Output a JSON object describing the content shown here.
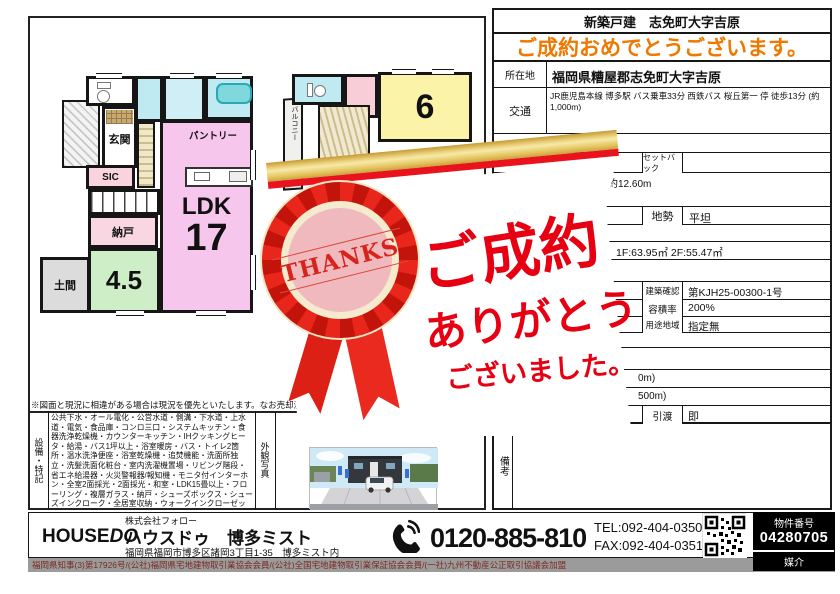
{
  "right_panel": {
    "title": "新築戸建　志免町大字吉原",
    "congrats": "ご成約おめでとうございます。",
    "rows": {
      "location_label": "所在地",
      "location_value": "福岡県糟屋郡志免町大字吉原",
      "access_label": "交通",
      "access_value": "JR鹿児島本線 博多駅 バス乗車33分 西鉄バス 桜丘第一 停 徒歩13分 (約1,000m)",
      "setback_label": "セットバック",
      "setback_value": "",
      "road_fragment": "約12.60m",
      "terrain_label": "地勢",
      "terrain_value": "平坦",
      "area_fragment": "1F:63.95㎡ 2F:55.47㎡",
      "confirmation_label": "建築確認",
      "confirmation_value": "第KJH25-00300-1号",
      "far_label": "容積率",
      "far_value": "200%",
      "zoning_label": "用途地域",
      "zoning_value": "指定無",
      "distance_fragment1": "0m)",
      "distance_fragment2": "500m)",
      "handover_label": "引渡",
      "handover_value": "即",
      "remarks_label": "備考"
    }
  },
  "floorplan": {
    "f1": {
      "genkan": "玄関",
      "sic": "SIC",
      "nando": "納戸",
      "washitsu_size": "4.5",
      "doma": "土間",
      "pantry": "パントリー",
      "ldk": "LDK",
      "ldk_size": "17"
    },
    "f2": {
      "room_size": "6",
      "balcony": "バルコニー"
    }
  },
  "ribbon": {
    "thanks": "THANKS"
  },
  "message": {
    "line1": "ご成約",
    "line2": "ありがとう",
    "line3": "ございました。"
  },
  "notes": {
    "disclaimer": "※図面と現況に相違がある場合は現況を優先といたします。なお売却済の場合",
    "equipment_label": "設備・特記",
    "equipment": "公共下水・オール電化・公営水道・側溝・下水道・上水道・電気・食品庫・コンロ三口・システムキッチン・食器洗浄乾燥機・カウンターキッチン・IHクッキングヒータ・給湯・バス1坪以上・浴室暖房・バス・トイレ2箇所・温水洗浄便座・浴室乾燥機・追焚機能・洗面所独立・洗髪洗面化粧台・室内洗濯機置場・リビング階段・省エネ給湯器・火災警報器/報知機・モニタ付インターホン・全室2面採光・2面採光・和室・LDK15畳以上・フローリング・複層ガラス・納戸・シューズボックス・シューズインクローク・全居室収納・ウォークインクローゼット・2面バルコニー",
    "environment": "小学校徒歩10分以内・閑静な住宅街・陽当り良好・通風良好・平",
    "photo_label": "外観写真"
  },
  "footer": {
    "logo_house": "HOUSE",
    "logo_do": "DO",
    "company": "株式会社フォロー",
    "office": "ハウスドゥ　博多ミスト",
    "address": "福岡県福岡市博多区諸岡3丁目1-35　博多ミスト内",
    "freedial": "0120-885-810",
    "tel": "TEL:092-404-0350",
    "fax": "FAX:092-404-0351",
    "property_label": "物件番号",
    "property_no": "04280705",
    "deal_type": "媒介",
    "license": "福岡県知事(3)第17926号/(公社)福岡県宅地建物取引業協会会員/(公社)全国宅地建物取引業保証協会会員/(一社)九州不動産公正取引協議会加盟"
  },
  "colors": {
    "congrats_orange": "#ee7800",
    "message_red": "#e60012",
    "ribbon_red": "#e8261b",
    "band_gold": "#e3c05a"
  }
}
